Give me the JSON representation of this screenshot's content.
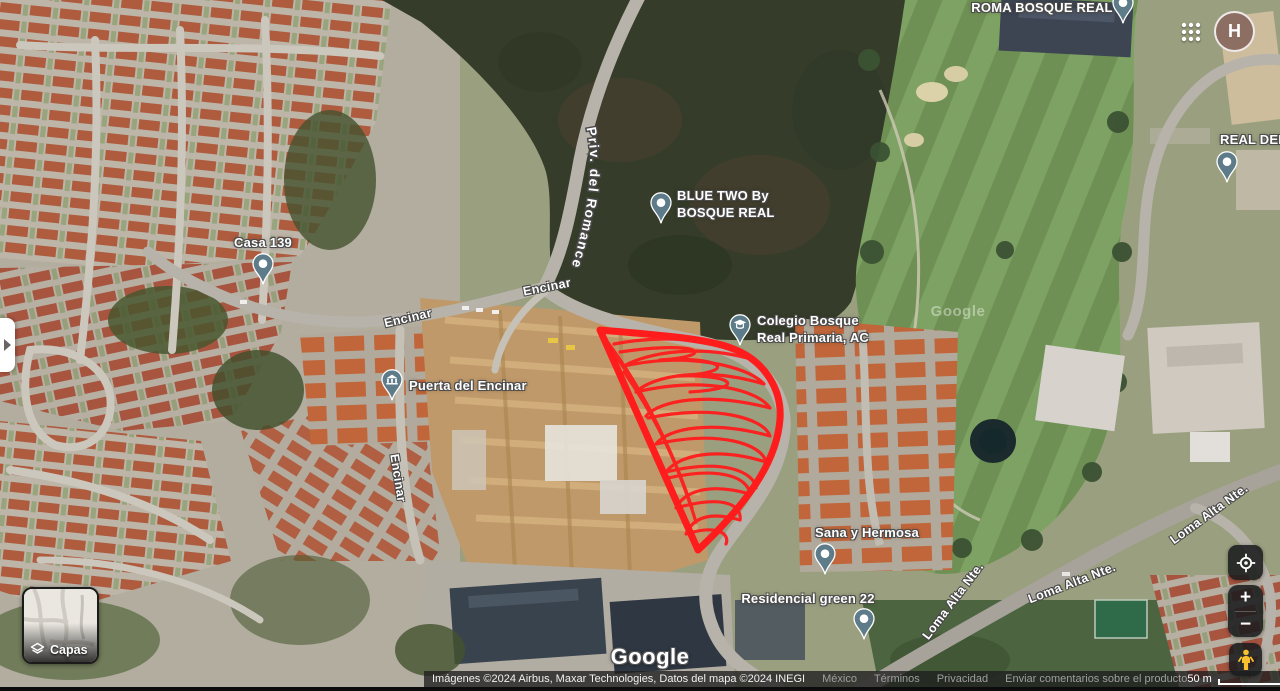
{
  "topbar": {
    "avatar_initial": "H"
  },
  "colors": {
    "polygon_red": "#ff1c1c",
    "pin_body": "#5d7b89",
    "avatar_bg": "#8d6e63"
  },
  "map": {
    "watermark": "Google",
    "google_logo": "Google",
    "curved_street_label": "Priv. del Romance",
    "pois": [
      {
        "id": "roma-bosque-real",
        "icon": "dot",
        "pin": {
          "x": 1112,
          "y": -8
        },
        "label": {
          "x": 1042,
          "y": 0,
          "align": "center"
        },
        "lines": [
          "ROMA BOSQUE REAL"
        ]
      },
      {
        "id": "casa-139",
        "icon": "dot",
        "pin": {
          "x": 252,
          "y": 253
        },
        "label": {
          "x": 263,
          "y": 235,
          "align": "center"
        },
        "lines": [
          "Casa 139"
        ]
      },
      {
        "id": "blue-two-by-bosque-real",
        "icon": "dot",
        "pin": {
          "x": 650,
          "y": 192
        },
        "label": {
          "x": 677,
          "y": 188,
          "align": "left"
        },
        "lines": [
          "BLUE TWO By",
          "BOSQUE REAL"
        ]
      },
      {
        "id": "real-del",
        "icon": "dot",
        "pin": {
          "x": 1216,
          "y": 151
        },
        "label": {
          "x": 1220,
          "y": 132,
          "align": "left"
        },
        "lines": [
          "REAL DEL"
        ]
      },
      {
        "id": "colegio-bosque-real-primaria",
        "icon": "school",
        "pin": {
          "x": 729,
          "y": 314
        },
        "label": {
          "x": 757,
          "y": 313,
          "align": "left"
        },
        "lines": [
          "Colegio Bosque",
          "Real Primaria, AC"
        ]
      },
      {
        "id": "puerta-del-encinar",
        "icon": "gate",
        "pin": {
          "x": 381,
          "y": 369
        },
        "label": {
          "x": 409,
          "y": 378,
          "align": "left"
        },
        "lines": [
          "Puerta del Encinar"
        ]
      },
      {
        "id": "sana-y-hermosa",
        "icon": "dot",
        "pin": {
          "x": 814,
          "y": 543
        },
        "label": {
          "x": 867,
          "y": 525,
          "align": "center"
        },
        "lines": [
          "Sana y Hermosa"
        ]
      },
      {
        "id": "residencial-green-22",
        "icon": "dot",
        "pin": {
          "x": 853,
          "y": 608
        },
        "label": {
          "x": 808,
          "y": 591,
          "align": "center"
        },
        "lines": [
          "Residencial green 22"
        ]
      }
    ],
    "street_labels": [
      {
        "text": "Encinar",
        "x": 408,
        "y": 318,
        "rot": -13
      },
      {
        "text": "Encinar",
        "x": 547,
        "y": 287,
        "rot": -11
      },
      {
        "text": "Encinar",
        "x": 398,
        "y": 478,
        "rot": 81
      },
      {
        "text": "Loma Alta Nte.",
        "x": 953,
        "y": 601,
        "rot": -53
      },
      {
        "text": "Loma Alta Nte.",
        "x": 1072,
        "y": 583,
        "rot": -21
      },
      {
        "text": "Loma Alta Nte.",
        "x": 1209,
        "y": 514,
        "rot": -36
      }
    ]
  },
  "controls": {
    "layers_label": "Capas",
    "zoom_in": "+",
    "zoom_out": "−"
  },
  "attribution": {
    "imagery": "Imágenes ©2024 Airbus, Maxar Technologies, Datos del mapa ©2024 INEGI",
    "links": [
      "México",
      "Términos",
      "Privacidad",
      "Enviar comentarios sobre el producto"
    ],
    "scale_label": "50 m"
  }
}
